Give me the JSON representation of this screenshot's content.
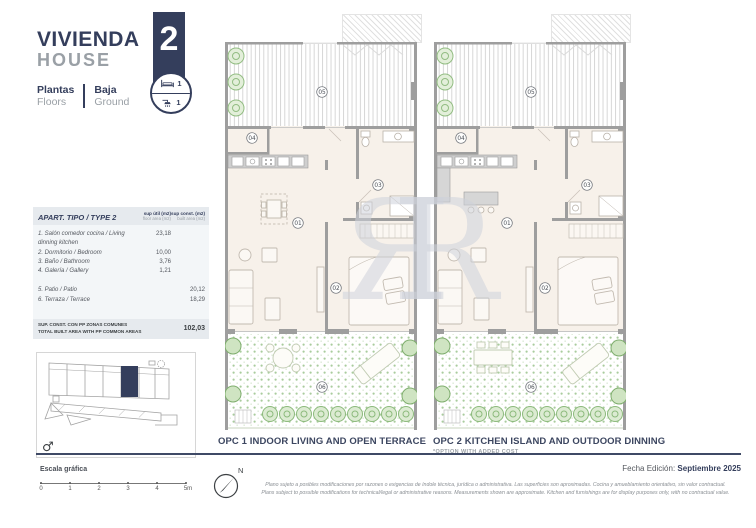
{
  "header": {
    "title_es": "VIVIENDA",
    "title_en": "HOUSE",
    "unit_number": "2",
    "floors_label_es": "Plantas",
    "floors_label_en": "Floors",
    "floor_value_es": "Baja",
    "floor_value_en": "Ground",
    "bedrooms_count": "1",
    "bathrooms_count": "1",
    "accent_color": "#343e5c"
  },
  "area_table": {
    "title": "APART. TIPO / TYPE 2",
    "col1_header_es": "sup útil (m2)",
    "col1_header_en": "floor area (m2)",
    "col2_header_es": "sup const. (m2)",
    "col2_header_en": "built area (m2)",
    "rows": [
      {
        "label": "1. Salón comedor cocina / Living dinning kitchen",
        "floor_area": "23,18",
        "built_area": ""
      },
      {
        "label": "2. Dormitorio / Bedroom",
        "floor_area": "10,00",
        "built_area": ""
      },
      {
        "label": "3. Baño / Bathroom",
        "floor_area": "3,76",
        "built_area": ""
      },
      {
        "label": "4. Galería / Gallery",
        "floor_area": "1,21",
        "built_area": ""
      },
      {
        "label": "5. Patio / Patio",
        "floor_area": "",
        "built_area": "20,12"
      },
      {
        "label": "6. Terraza / Terrace",
        "floor_area": "",
        "built_area": "18,29"
      }
    ],
    "total_label_es": "SUP. CONST. CON PP ZONAS COMUNES",
    "total_label_en": "TOTAL BUILT AREA WITH PP COMMON AREAS",
    "total_value": "102,03"
  },
  "room_numbers": {
    "living": "01",
    "bedroom": "02",
    "bathroom": "03",
    "gallery": "04",
    "patio": "05",
    "terrace": "06"
  },
  "plans": [
    {
      "caption": "OPC 1 INDOOR LIVING AND OPEN TERRACE",
      "note": ""
    },
    {
      "caption": "OPC 2 KITCHEN ISLAND AND OUTDOOR DINNING",
      "note": "*OPTION WITH ADDED COST"
    }
  ],
  "site_plan": {
    "compass_symbol": "♂"
  },
  "watermark": {
    "text": "ЯR"
  },
  "footer": {
    "scale_label": "Escala gráfica",
    "scale_ticks": [
      "0",
      "1",
      "2",
      "3",
      "4",
      "5m"
    ],
    "north_label": "N",
    "edition_label": "Fecha Edición:",
    "edition_value": "Septiembre 2025",
    "disclaimer_es": "Plano sujeto a posibles modificaciones por razones o exigencias de índole técnica, jurídica o administrativa. Las superficies son aproximadas. Cocina y amueblamiento orientativo, sin valor contractual.",
    "disclaimer_en": "Plans subject to possible modifications for technical/legal or administrative reasons. Measurements shown are approximate. Kitchen and furnishings are for display purposes only, with no contractual value."
  }
}
